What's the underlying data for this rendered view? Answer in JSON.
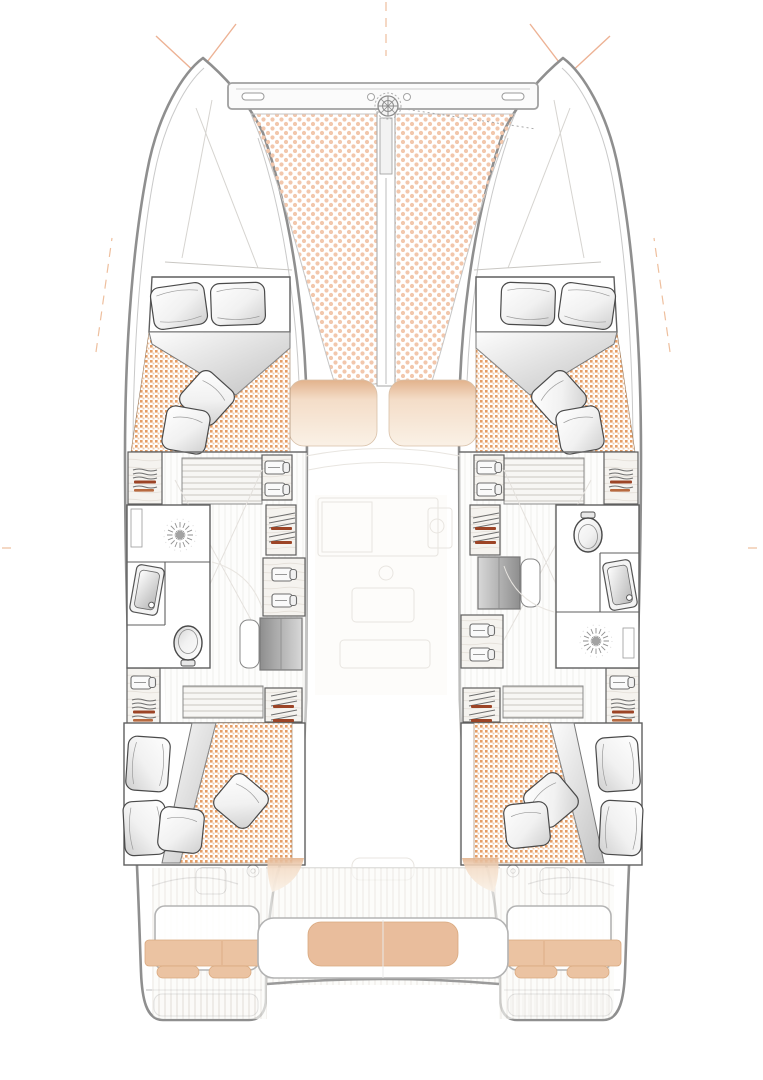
{
  "page": {
    "title": "Sailing catamaran accommodation plan — top view",
    "subtitle": "4 double cabins, 2 bathrooms, bow trampolines, forward and aft cockpits"
  },
  "colors": {
    "hull-line": "#8f8f8f",
    "line-light": "#c9c9c9",
    "furn-line": "#5f5f5f",
    "ghost": "#e8e5e0",
    "accent-x": "#edb294",
    "accent-dash": "#e8a97e",
    "tramp-dot": "#f2c7ac",
    "weave-a": "#e59e66",
    "weave-b": "#f2c9a6",
    "cushion": "#ebc3a2",
    "cushion-edge": "#d9a97f",
    "cushion-deep": "#e9bd9c",
    "seat-top": "#e2b28c",
    "seat-mid": "#f4ddc8",
    "seat-low": "#faf1e6",
    "rust": "#9c4426",
    "steel-dark": "#8e8e8e",
    "steel-light": "#d8d8d8"
  },
  "areas": {
    "trampoline_port": {
      "label": "Bow trampoline — port",
      "pattern": "dotted mesh"
    },
    "trampoline_starboard": {
      "label": "Bow trampoline — starboard",
      "pattern": "dotted mesh"
    },
    "crossbeam": {
      "label": "Forward crossbeam with mooring cleats"
    },
    "windlass": {
      "label": "Anchor windlass at mast foot"
    },
    "forward_cockpit": {
      "label": "Forward cockpit lounge",
      "cushions": 2
    },
    "cabin_forward_port": {
      "label": "Forward double cabin — port",
      "pillows": 2,
      "throw_pillows": 2,
      "duvet": "turned back"
    },
    "cabin_forward_starboard": {
      "label": "Forward double cabin — starboard",
      "pillows": 2,
      "throw_pillows": 2,
      "duvet": "turned back"
    },
    "head_port": {
      "label": "Bathroom — port hull",
      "fixtures": [
        "shower with drain",
        "washbasin",
        "toilet"
      ]
    },
    "head_starboard": {
      "label": "Bathroom — starboard hull",
      "fixtures": [
        "toilet",
        "washbasin",
        "shower with drain"
      ]
    },
    "wardrobes_port": {
      "label": "Wardrobes and lockers — port hull",
      "contents": [
        "folded shirts",
        "hanging clothes",
        "folded linen"
      ]
    },
    "wardrobes_starboard": {
      "label": "Wardrobes and lockers — starboard hull",
      "contents": [
        "folded shirts",
        "hanging clothes",
        "folded linen"
      ]
    },
    "companionway_port": {
      "label": "Companionway steps down — port hull"
    },
    "companionway_starboard": {
      "label": "Companionway steps down — starboard hull"
    },
    "salon": {
      "label": "Salon / galley (main deck, ghosted)"
    },
    "cabin_aft_port": {
      "label": "Aft double cabin — port",
      "pillows": 2,
      "throw_pillows": 2
    },
    "cabin_aft_starboard": {
      "label": "Aft double cabin — starboard",
      "pillows": 2,
      "throw_pillows": 2
    },
    "aft_cockpit": {
      "label": "Aft cockpit with bench seating",
      "benches": 3,
      "teak_sole": true
    },
    "swim_platform_port": {
      "label": "Transom swim step — port"
    },
    "swim_platform_starboard": {
      "label": "Transom swim step — starboard"
    }
  },
  "icons": [
    "windlass-icon",
    "shower-drain-icon",
    "toilet-icon",
    "washbasin-icon",
    "folded-shirt-icon",
    "clothes-stack-icon",
    "hanging-clothes-icon",
    "pillow-icon",
    "throw-pillow-icon",
    "cleat-icon"
  ]
}
